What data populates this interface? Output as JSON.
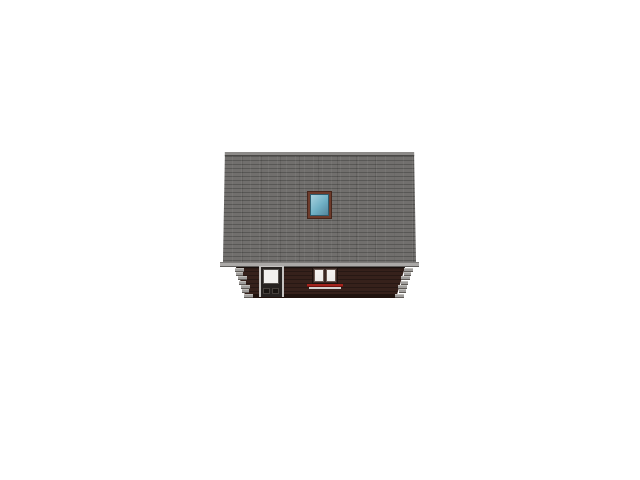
{
  "scene": {
    "subject": "Side elevation render of a log house with a large shingled roof",
    "background_color": "#ffffff",
    "parts": [
      "shingled-roof",
      "ridge-cap",
      "roof-skylight",
      "eave-fascia",
      "log-wall",
      "corner-log-ends-left",
      "corner-log-ends-right",
      "entry-door",
      "double-window",
      "window-sill"
    ]
  },
  "colors": {
    "background": "#ffffff",
    "roof": "#716f6d",
    "ridge": "#8c8a88",
    "ridge_edge": "#4a4846",
    "fascia": "#aba9a7",
    "fascia_edge": "#605e5c",
    "wall": "#36211b",
    "wall_base": "#20130e",
    "log_end": "#a09e9c",
    "log_end_shadow": "#5f5b57",
    "skylight_frame": "#6e3b2b",
    "skylight_frame_dark": "#46251a",
    "skylight_glass": "#6fb0c4",
    "skylight_glass_light": "#a9d2de",
    "door_trim": "#c5c3c1",
    "door_slab": "#262220",
    "door_glass": "#f1f0ee",
    "door_panel": "#181411",
    "window_frame": "#3a2823",
    "window_glass": "#edecea",
    "sill_red": "#a3231c",
    "sill_light": "#d3d1cf"
  }
}
